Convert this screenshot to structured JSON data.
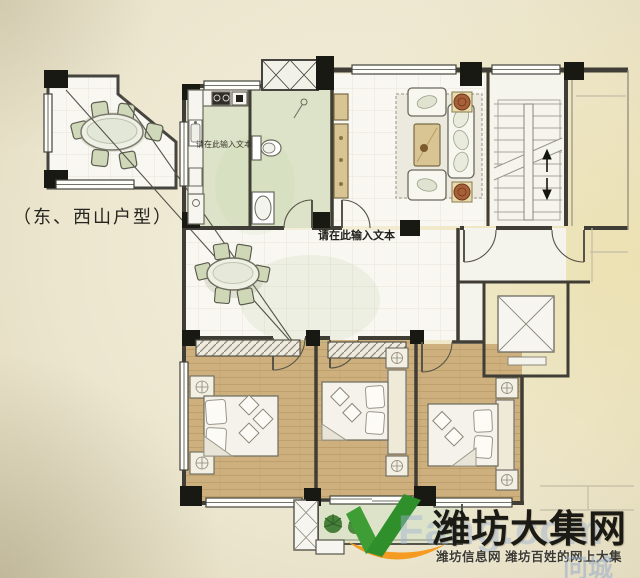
{
  "floor_plan": {
    "unit_type_label": "（东、西山户型）",
    "kitchen_note": "请在此输入文本",
    "entry_note": "请在此输入文本"
  },
  "watermark": {
    "site_name": "潍坊大集网",
    "tagline": "潍坊信息网 潍坊百姓的网上大集",
    "background_text": "Fang.com",
    "corner_text": "问城"
  },
  "palette": {
    "paper": "#ece6cf",
    "room_floor_green": "#dde3c8",
    "bedroom_wood": "#cdb07d",
    "wall_line": "#3f3d35",
    "furniture_tan": "#d9c493",
    "logo_green": "#3f9d36",
    "logo_orange": "#f59b22"
  }
}
